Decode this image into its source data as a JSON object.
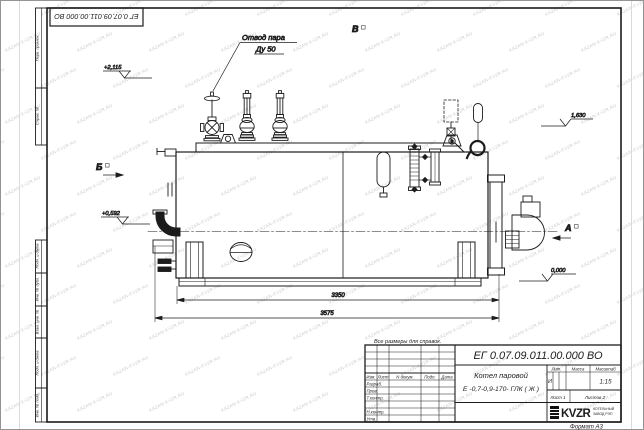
{
  "page": {
    "designation_repeat": "ЕГ 0.07.09.011.00.000  ВО",
    "note": "Все размеры для справок.",
    "format_label": "Формат А3",
    "watermark": "KAZAN-KVZR.RU"
  },
  "annotations": {
    "steam_outlet_line1": "Отвод пара",
    "steam_outlet_line2": "Ду 50",
    "view_b_top": "В",
    "view_b_left": "Б",
    "view_a_right": "А",
    "elev_plus_2115": "+2,115",
    "elev_plus_0592": "+0,592",
    "elev_1630": "1,630",
    "elev_0000": "0,000",
    "dim_3350": "3350",
    "dim_3575": "3575"
  },
  "margin_labels": [
    "Перв. примен.",
    "Справ. №",
    "Подп. и дата",
    "Инв. № дубл.",
    "Взам. инв. №",
    "Подп. и дата",
    "Инв. № подл."
  ],
  "title_block": {
    "designation": "ЕГ 0.07.09.011.00.000  ВО",
    "product_line1": "Котел паровой",
    "product_line2": "Е -0,7-0,9-170- ГЛК ( Ж )",
    "header_cols": [
      "Изм.",
      "Лист",
      "N докум.",
      "Подп.",
      "Дата"
    ],
    "signature_rows": [
      "Разраб.",
      "Пров.",
      "Т.контр.",
      "Н.контр.",
      "Утв."
    ],
    "lit_label": "Лит.",
    "lit_value": "И",
    "mass_label": "Масса",
    "scale_label": "Масштаб",
    "scale_value": "1:15",
    "sheet_text": "Лист 1",
    "sheets_text": "Листов  2",
    "logo_text": "KVZR",
    "company_line1": "КОТЕЛЬНЫЙ",
    "company_line2": "ЗАВОД РЭП"
  }
}
